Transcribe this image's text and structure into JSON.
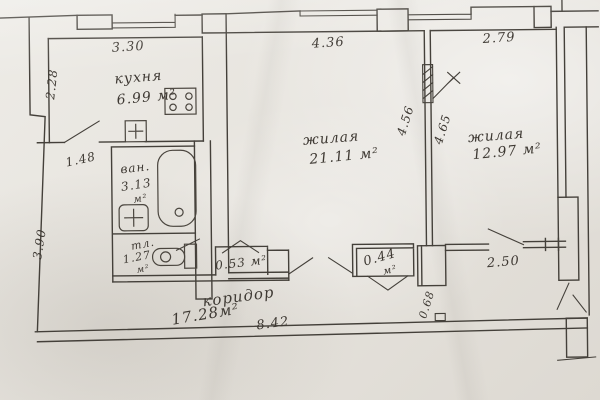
{
  "document": {
    "type": "apartment floor plan (scanned hand drawing)"
  },
  "colors": {
    "paper": "#e9e6e0",
    "ink": "#3e3933"
  },
  "rooms": {
    "kitchen": {
      "label": "кухня",
      "area": "6.99 м²"
    },
    "living1": {
      "label": "жилая",
      "area": "21.11 м²"
    },
    "living2": {
      "label": "жилая",
      "area": "12.97 м²"
    },
    "bath": {
      "label": "ван.",
      "area": "3.13",
      "unit": "м²"
    },
    "wc": {
      "label": "тл.",
      "area": "1.27",
      "unit": "м²"
    },
    "corridor": {
      "label": "коридор",
      "area": "17.28м²"
    },
    "closet_small": {
      "area": "0.53 м²"
    },
    "closet_tiny": {
      "area": "0.44",
      "unit": "м²"
    }
  },
  "dimensions": {
    "kitchen_top": "3.30",
    "living1_top": "4.36",
    "living2_top": "2.79",
    "kitchen_left": "2.28",
    "hall_door": "1.48",
    "left_lower": "3.90",
    "living1_side": "4.56",
    "living2_side": "4.65",
    "corridor_bottom": "8.42",
    "right_passage": "2.50",
    "duct": "0.68"
  },
  "icons": {
    "stove": "stove-4-burners-icon",
    "kitchen_sink": "sink-cross-icon",
    "washbasin": "washbasin-cross-icon",
    "bathtub": "bathtub-icon",
    "toilet": "toilet-icon",
    "vent_arrow": "vent-shaft-arrow-icon"
  }
}
